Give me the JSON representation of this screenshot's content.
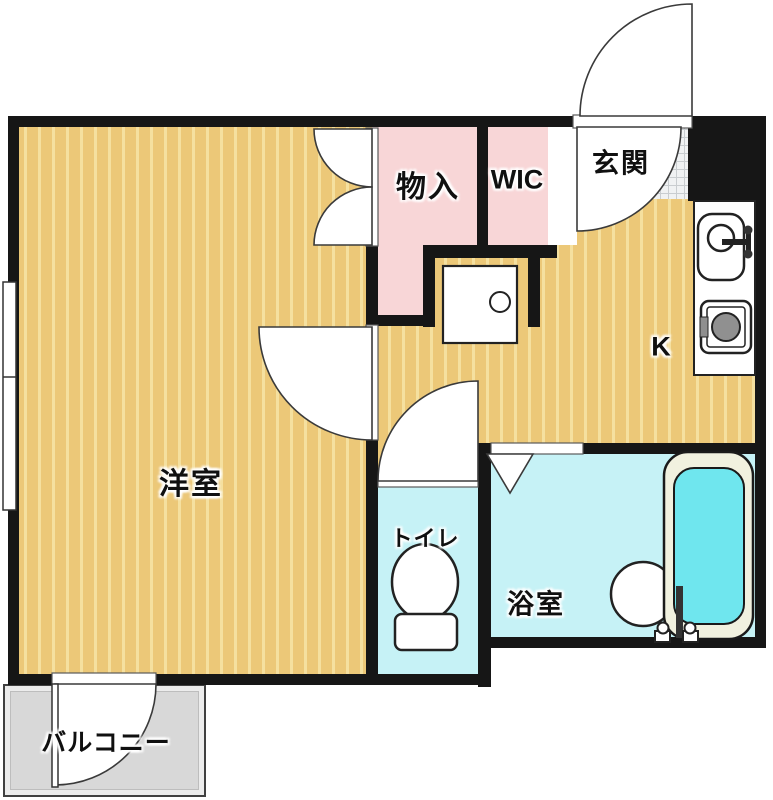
{
  "floorplan": {
    "type": "apartment-floor-plan",
    "rooms": [
      {
        "id": "western-room",
        "label": "洋室"
      },
      {
        "id": "storage",
        "label": "物入"
      },
      {
        "id": "wic",
        "label": "WIC"
      },
      {
        "id": "entrance",
        "label": "玄関"
      },
      {
        "id": "kitchen",
        "label": "K"
      },
      {
        "id": "toilet",
        "label": "トイレ"
      },
      {
        "id": "bathroom",
        "label": "浴室"
      },
      {
        "id": "balcony",
        "label": "バルコニー"
      }
    ],
    "colors": {
      "wall": "#161616",
      "wood_floor": "#ecc878",
      "wood_stripe": "#f5e09f",
      "closet_pink": "#f8d6d7",
      "wet_cyan": "#c6f2f6",
      "tub_water": "#6fe6ee",
      "balcony_gray": "#d8d8d8",
      "tile_grid": "#c9cdd0"
    }
  }
}
